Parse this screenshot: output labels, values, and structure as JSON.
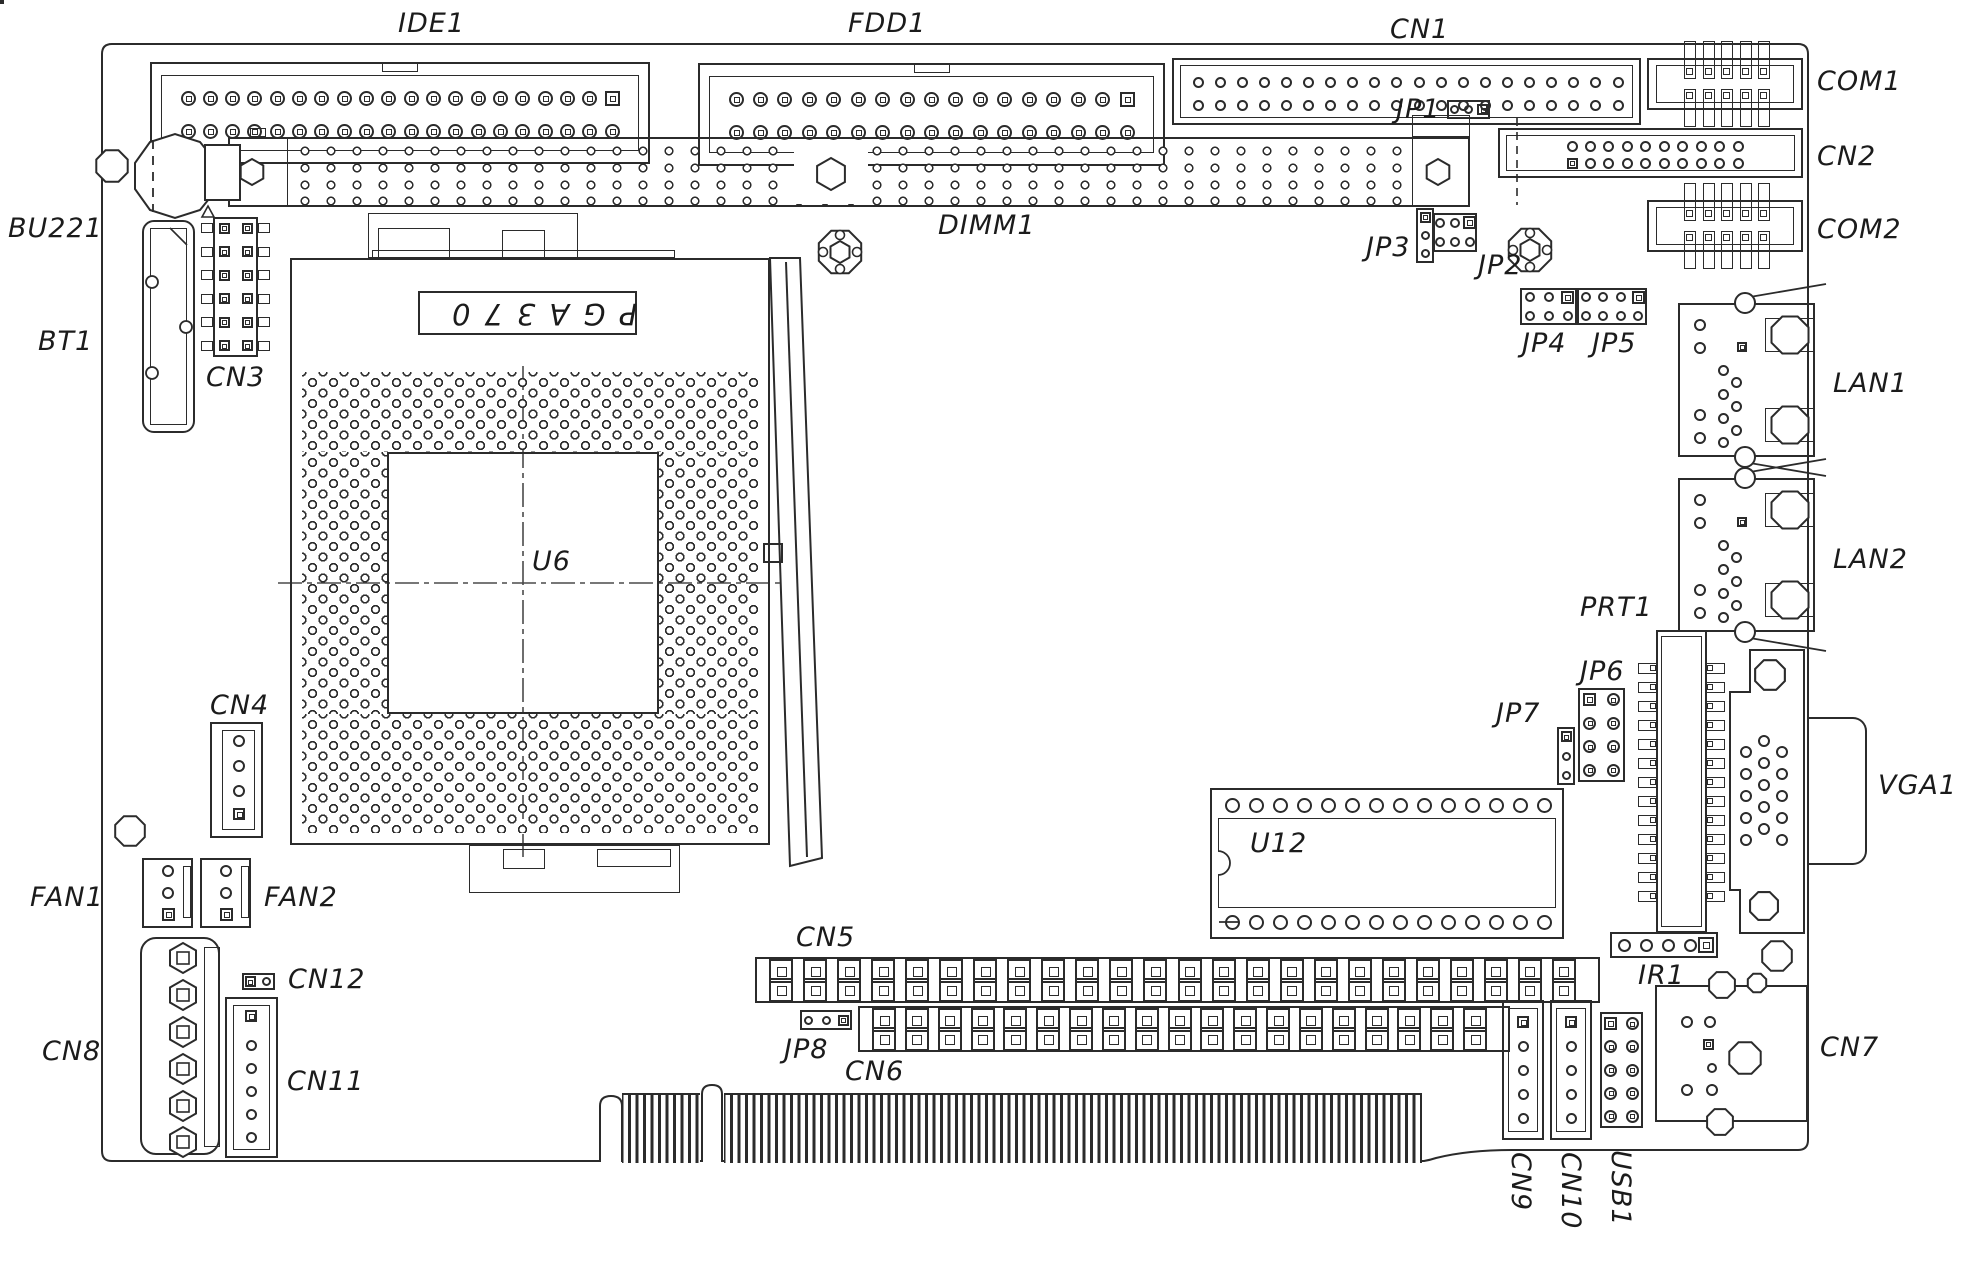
{
  "drawing": "single-board-computer component layout",
  "colors": {
    "line": "#2b2b2b",
    "background": "#ffffff",
    "text": "#1b1b1b"
  },
  "socket_text": "PGA370",
  "labels": [
    {
      "name": "ide1-label",
      "text": "IDE1",
      "x": 398,
      "y": 10
    },
    {
      "name": "fdd1-label",
      "text": "FDD1",
      "x": 848,
      "y": 10
    },
    {
      "name": "cn1-label",
      "text": "CN1",
      "x": 1390,
      "y": 16
    },
    {
      "name": "com1-label",
      "text": "COM1",
      "x": 1817,
      "y": 68
    },
    {
      "name": "bu221-label",
      "text": "BU221",
      "x": 8,
      "y": 215
    },
    {
      "name": "cn2-label",
      "text": "CN2",
      "x": 1817,
      "y": 143
    },
    {
      "name": "dimm1-label",
      "text": "DIMM1",
      "x": 938,
      "y": 212
    },
    {
      "name": "jp1-label",
      "text": "JP1",
      "x": 1396,
      "y": 96
    },
    {
      "name": "jp3-label",
      "text": "JP3",
      "x": 1366,
      "y": 234
    },
    {
      "name": "jp2-label",
      "text": "JP2",
      "x": 1478,
      "y": 252
    },
    {
      "name": "com2-label",
      "text": "COM2",
      "x": 1817,
      "y": 216
    },
    {
      "name": "jp4-label",
      "text": "JP4",
      "x": 1522,
      "y": 330
    },
    {
      "name": "jp5-label",
      "text": "JP5",
      "x": 1592,
      "y": 330
    },
    {
      "name": "bt1-label",
      "text": "BT1",
      "x": 38,
      "y": 328
    },
    {
      "name": "cn3-label",
      "text": "CN3",
      "x": 206,
      "y": 364
    },
    {
      "name": "lan1-label",
      "text": "LAN1",
      "x": 1833,
      "y": 370
    },
    {
      "name": "lan2-label",
      "text": "LAN2",
      "x": 1833,
      "y": 546
    },
    {
      "name": "prt1-label",
      "text": "PRT1",
      "x": 1580,
      "y": 594
    },
    {
      "name": "jp6-label",
      "text": "JP6",
      "x": 1580,
      "y": 658
    },
    {
      "name": "jp7-label",
      "text": "JP7",
      "x": 1496,
      "y": 700
    },
    {
      "name": "vga1-label",
      "text": "VGA1",
      "x": 1878,
      "y": 772
    },
    {
      "name": "u6-label",
      "text": "U6",
      "x": 532,
      "y": 548
    },
    {
      "name": "cn4-label",
      "text": "CN4",
      "x": 210,
      "y": 692
    },
    {
      "name": "u12-label",
      "text": "U12",
      "x": 1250,
      "y": 830
    },
    {
      "name": "ir1-label",
      "text": "IR1",
      "x": 1638,
      "y": 962
    },
    {
      "name": "fan1-label",
      "text": "FAN1",
      "x": 30,
      "y": 884
    },
    {
      "name": "fan2-label",
      "text": "FAN2",
      "x": 264,
      "y": 884
    },
    {
      "name": "cn5-label",
      "text": "CN5",
      "x": 796,
      "y": 924
    },
    {
      "name": "cn12-label",
      "text": "CN12",
      "x": 288,
      "y": 966
    },
    {
      "name": "jp8-label",
      "text": "JP8",
      "x": 784,
      "y": 1036
    },
    {
      "name": "cn8-label",
      "text": "CN8",
      "x": 42,
      "y": 1038
    },
    {
      "name": "cn11-label",
      "text": "CN11",
      "x": 287,
      "y": 1068
    },
    {
      "name": "cn6-label",
      "text": "CN6",
      "x": 845,
      "y": 1058
    },
    {
      "name": "cn7-label",
      "text": "CN7",
      "x": 1820,
      "y": 1034
    },
    {
      "name": "cn9-label",
      "text": "CN9",
      "x": 1534,
      "y": 1152,
      "rot": 90
    },
    {
      "name": "cn10-label",
      "text": "CN10",
      "x": 1584,
      "y": 1152,
      "rot": 90
    },
    {
      "name": "usb1-label",
      "text": "USB1",
      "x": 1634,
      "y": 1150,
      "rot": 90
    }
  ],
  "components": [
    {
      "name": "ide1-connector",
      "type": "ribbon",
      "x": 150,
      "y": 62,
      "w": 500,
      "h": 102,
      "cols": 20
    },
    {
      "name": "fdd1-connector",
      "type": "ribbon",
      "x": 698,
      "y": 63,
      "w": 467,
      "h": 103,
      "cols": 17
    },
    {
      "name": "cn1-header",
      "type": "boxheader",
      "x": 1172,
      "y": 58,
      "w": 469,
      "h": 67,
      "cols": 20,
      "padStart": 26,
      "padSpan": 420,
      "sq": "none"
    },
    {
      "name": "com1-header",
      "type": "comport",
      "x": 1647,
      "y": 58
    },
    {
      "name": "com2-header",
      "type": "comport",
      "x": 1647,
      "y": 200
    },
    {
      "name": "cn2-header",
      "type": "boxheader",
      "x": 1498,
      "y": 128,
      "w": 305,
      "h": 50,
      "cols": 10,
      "padStart": 74,
      "padSpan": 166,
      "sq": "bl"
    },
    {
      "name": "dimm1-socket",
      "type": "dimm",
      "x": 228,
      "y": 137,
      "w": 1242,
      "h": 70,
      "keyX": 831
    },
    {
      "name": "cpu-socket-u6",
      "type": "cpu"
    },
    {
      "name": "u12-chip",
      "type": "dip",
      "x": 1210,
      "y": 788,
      "w": 354,
      "h": 151,
      "pins": 14
    },
    {
      "name": "cn5-header",
      "type": "sqheader",
      "x": 755,
      "y": 957,
      "w": 845,
      "h": 46,
      "cols": 24
    },
    {
      "name": "cn6-header",
      "type": "sqheader",
      "x": 858,
      "y": 1006,
      "w": 652,
      "h": 46,
      "cols": 19
    },
    {
      "name": "jp1-jumper",
      "type": "jumper",
      "x": 1447,
      "y": 100,
      "w": 43,
      "h": 19,
      "pins": 3,
      "dir": "h",
      "sq": "end"
    },
    {
      "name": "jp3-jumper",
      "type": "jumper",
      "x": 1416,
      "y": 208,
      "w": 18,
      "h": 55,
      "pins": 3,
      "dir": "v",
      "sq": "start"
    },
    {
      "name": "jp2-jumper",
      "type": "pingrid",
      "x": 1433,
      "y": 213,
      "w": 44,
      "h": 39,
      "cols": 3,
      "rows": 2,
      "sq": [
        [
          0,
          2
        ]
      ],
      "pad": "circ"
    },
    {
      "name": "jp4-jumper",
      "type": "pingrid",
      "x": 1520,
      "y": 288,
      "w": 57,
      "h": 37,
      "cols": 3,
      "rows": 2,
      "sq": [
        [
          0,
          2
        ]
      ],
      "pad": "circ"
    },
    {
      "name": "jp5-jumper",
      "type": "pingrid",
      "x": 1577,
      "y": 288,
      "w": 70,
      "h": 37,
      "cols": 4,
      "rows": 2,
      "sq": [
        [
          0,
          3
        ]
      ],
      "pad": "circ"
    },
    {
      "name": "jp6-jumper",
      "type": "pingrid",
      "x": 1578,
      "y": 688,
      "w": 47,
      "h": 94,
      "cols": 2,
      "rows": 4,
      "sq": [
        [
          0,
          0
        ]
      ],
      "pad": "ringsq"
    },
    {
      "name": "jp7-jumper",
      "type": "jumper",
      "x": 1557,
      "y": 727,
      "w": 18,
      "h": 58,
      "pins": 3,
      "dir": "v",
      "sq": "start"
    },
    {
      "name": "jp8-jumper",
      "type": "jumper",
      "x": 800,
      "y": 1010,
      "w": 52,
      "h": 20,
      "pins": 3,
      "dir": "h",
      "sq": "end"
    },
    {
      "name": "cn12-header",
      "type": "jumper",
      "x": 242,
      "y": 973,
      "w": 33,
      "h": 17,
      "pins": 2,
      "dir": "h",
      "sq": "start"
    },
    {
      "name": "lan1-port",
      "type": "rj45",
      "x": 1678,
      "y": 303,
      "w": 137,
      "h": 154
    },
    {
      "name": "lan2-port",
      "type": "rj45",
      "x": 1678,
      "y": 478,
      "w": 137,
      "h": 154
    },
    {
      "name": "vga1-port",
      "type": "vga"
    },
    {
      "name": "prt1-header",
      "type": "prt"
    },
    {
      "name": "ir1-header",
      "type": "ir",
      "x": 1610,
      "y": 932
    },
    {
      "name": "cn7-port",
      "type": "cn7",
      "x": 1655,
      "y": 985,
      "w": 153,
      "h": 137
    },
    {
      "name": "cn9-connector",
      "type": "vconn",
      "x": 1502,
      "y": 1000
    },
    {
      "name": "cn10-connector",
      "type": "vconn",
      "x": 1550,
      "y": 1000
    },
    {
      "name": "usb1-header",
      "type": "pingrid",
      "x": 1600,
      "y": 1012,
      "w": 43,
      "h": 116,
      "cols": 2,
      "rows": 5,
      "sq": [
        [
          0,
          0
        ]
      ],
      "pad": "ringsq"
    },
    {
      "name": "cn4-connector",
      "type": "cn4",
      "x": 210,
      "y": 722
    },
    {
      "name": "fan1-connector",
      "type": "fan",
      "x": 142,
      "y": 858
    },
    {
      "name": "fan2-connector",
      "type": "fan",
      "x": 200,
      "y": 858
    },
    {
      "name": "cn8-connector",
      "type": "cn8",
      "x": 140,
      "y": 937
    },
    {
      "name": "cn11-connector",
      "type": "cn11",
      "x": 225,
      "y": 997
    },
    {
      "name": "cn3-header",
      "type": "cn3",
      "x": 213,
      "y": 217
    },
    {
      "name": "bt1-holder",
      "type": "bt1",
      "x": 142,
      "y": 220
    },
    {
      "name": "bu221-battery",
      "type": "battery"
    },
    {
      "name": "edge-fingers-a",
      "type": "fingers",
      "x": 622,
      "y": 1093,
      "w": 78
    },
    {
      "name": "edge-fingers-b",
      "type": "fingers",
      "x": 724,
      "y": 1093,
      "w": 698
    },
    {
      "name": "mount-hole-1",
      "type": "oct",
      "cx": 112,
      "cy": 166,
      "r": 17
    },
    {
      "name": "mount-hole-2",
      "type": "oct",
      "cx": 130,
      "cy": 831,
      "r": 16
    },
    {
      "name": "mount-hole-3",
      "type": "oct",
      "cx": 1770,
      "cy": 675,
      "r": 16
    },
    {
      "name": "mount-hole-4",
      "type": "oct",
      "cx": 1764,
      "cy": 906,
      "r": 15
    },
    {
      "name": "mount-hole-5",
      "type": "oct",
      "cx": 1777,
      "cy": 956,
      "r": 16
    },
    {
      "name": "mount-hole-6",
      "type": "oct",
      "cx": 1757,
      "cy": 983,
      "r": 10
    },
    {
      "name": "mount-flower-1",
      "type": "flower",
      "cx": 840,
      "cy": 252,
      "r": 23
    },
    {
      "name": "mount-flower-2",
      "type": "flower",
      "cx": 1530,
      "cy": 250,
      "r": 23
    },
    {
      "name": "cn2-centerline",
      "type": "dash",
      "x": 1517,
      "y1": 118,
      "y2": 205
    }
  ]
}
